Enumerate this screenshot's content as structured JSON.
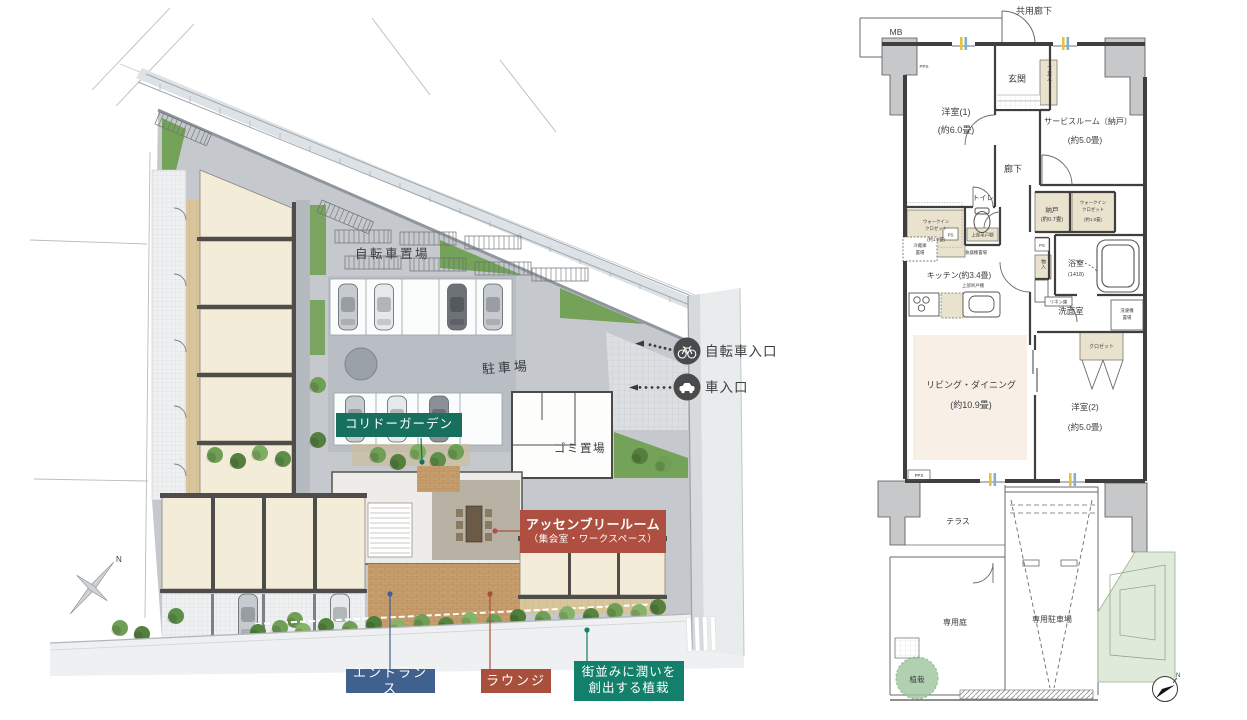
{
  "site_plan": {
    "areas": {
      "bicycle_parking": "自転車置場",
      "parking": "駐車場",
      "garbage": "ゴミ置場"
    },
    "badges": {
      "corridor_garden": "コリドーガーデン",
      "assembly_room_line1": "アッセンブリールーム",
      "assembly_room_line2": "（集会室・ワークスペース）",
      "entrance": "エントランス",
      "lounge": "ラウンジ",
      "street_planting_line1": "街並みに潤いを",
      "street_planting_line2": "創出する植栽"
    },
    "entries": {
      "bicycle": "自転車入口",
      "car": "車入口"
    },
    "north": "N"
  },
  "floor_plan": {
    "corridor": "共用廊下",
    "mb": "MB",
    "pps_top": "PPS",
    "entry": "玄関",
    "shoe_box": "下足入",
    "room1_name": "洋室(1)",
    "room1_size": "(約6.0畳)",
    "service_name": "サービスルーム〔納戸〕",
    "service_size": "(約5.0畳)",
    "hallway": "廊下",
    "wic12_l1": "ウォークイン",
    "wic12_l2": "クロゼット",
    "wic12_size": "(約1.2畳)",
    "toilet": "トイレ",
    "hang_toilet": "上部吊戸棚",
    "ps1": "PS",
    "ps2": "PS",
    "fridge_l1": "冷蔵庫",
    "fridge_l2": "置場",
    "cupboard": "食器棚置場",
    "nando_name": "納戸",
    "nando_size": "(約0.7畳)",
    "wic10_l1": "ウォークイン",
    "wic10_l2": "クロゼット",
    "wic10_size": "(約1.0畳)",
    "monoire": "物入",
    "bath_name": "浴室",
    "bath_size": "(1418)",
    "kitchen": "キッチン(約3.4畳)",
    "hang_kitchen": "上部吊戸棚",
    "linen": "リネン庫",
    "washroom": "洗面室",
    "washer_l1": "洗濯機",
    "washer_l2": "置場",
    "closet": "クロゼット",
    "living_name": "リビング・ダイニング",
    "living_size": "(約10.9畳)",
    "room2_name": "洋室(2)",
    "room2_size": "(約5.0畳)",
    "pps_bottom": "PPS",
    "terrace": "テラス",
    "garden": "専用庭",
    "private_parking": "専用駐車場",
    "planting": "植栽",
    "north": "N"
  },
  "colors": {
    "corridor_garden_badge": "#17705d",
    "assembly_badge": "#ae4f41",
    "entrance_badge": "#40618e",
    "lounge_badge": "#a9503d",
    "planting_badge": "#12806a",
    "entry_icon_bg": "#4a4a4a",
    "building_fill": "#f3ecd9",
    "living_fill": "#f8f0e7",
    "closet_fill": "#e9e2cd",
    "greenery": "#6f9e55",
    "brick_paving": "#c79e6e",
    "window_mark_yellow": "#e8c23a",
    "window_mark_blue": "#7ab0d4"
  }
}
